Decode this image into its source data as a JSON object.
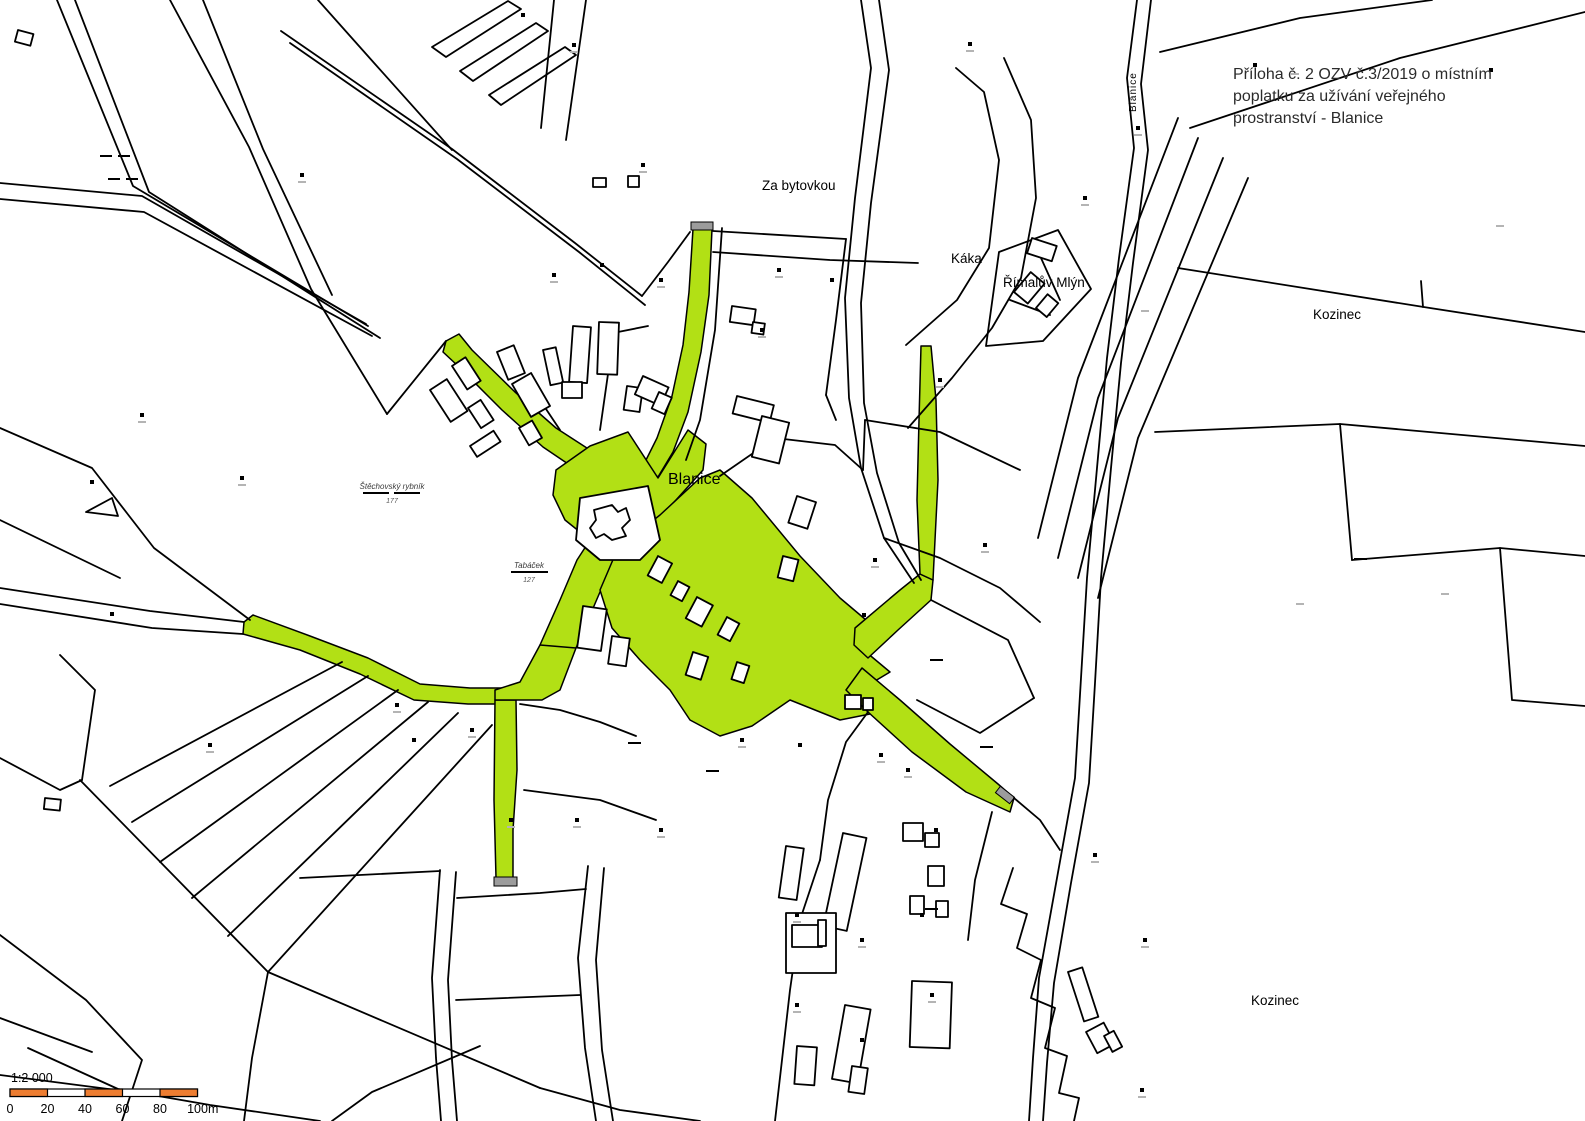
{
  "title": {
    "line1": "Příloha č. 2 OZV č.3/2019 o místním",
    "line2": "poplatku za užívání veřejného",
    "line3": "prostranství - Blanice"
  },
  "labels": {
    "za_bytovkou": "Za bytovkou",
    "kaka": "Káka",
    "rimaluv_mlyn": "Římalův Mlýn",
    "kozinec_top": "Kozinec",
    "kozinec_bottom": "Kozinec",
    "blanice_village": "Blanice",
    "blanice_river": "Blanice",
    "stechovsky_rybnik": "Štěchovský rybník",
    "stechovsky_rybnik_parcel": "177",
    "tabacek": "Tabáček",
    "tabacek_parcel": "127"
  },
  "scale_bar": {
    "ratio": "1:2 000",
    "ticks": [
      "0",
      "20",
      "40",
      "60",
      "80",
      "100"
    ],
    "unit": "m"
  },
  "colors": {
    "highlight_green": "#b2e015",
    "scalebar_orange": "#ed7d31",
    "road_end_gray": "#9c9c9c",
    "line_black": "#000000"
  }
}
